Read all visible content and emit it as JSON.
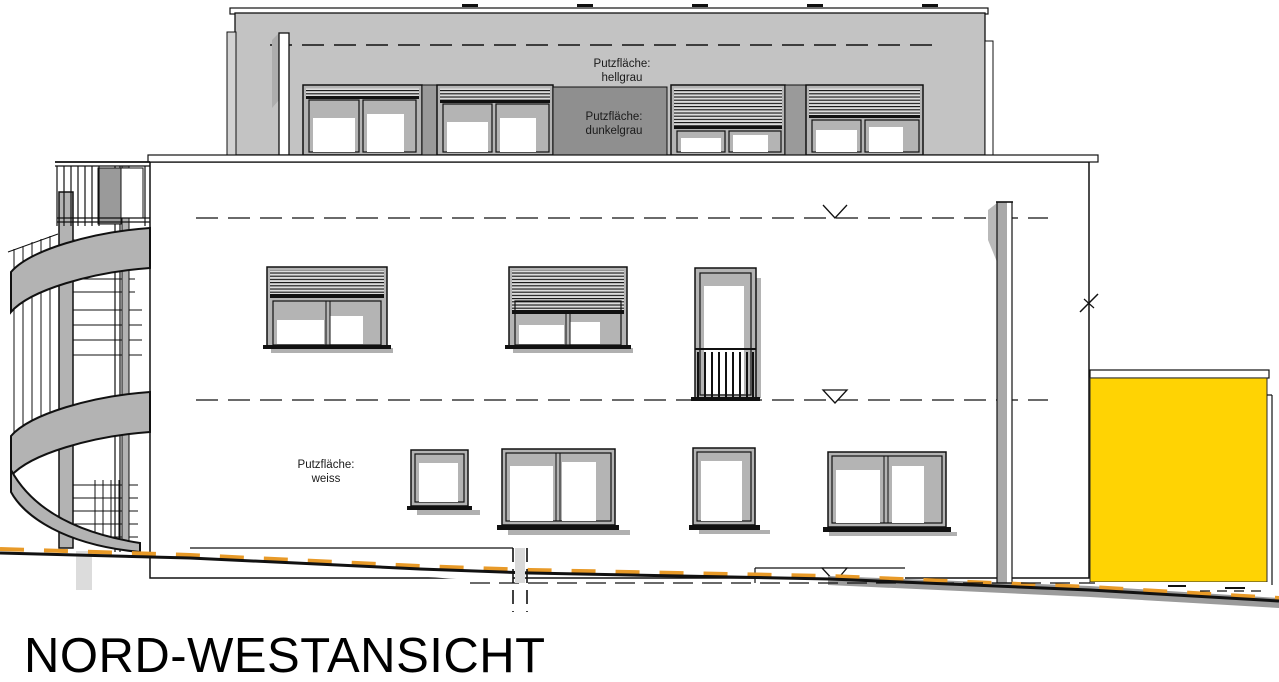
{
  "drawing": {
    "title": "NORD-WESTANSICHT",
    "annotations": {
      "hellgrau_line1": "Putzfläche:",
      "hellgrau_line2": "hellgrau",
      "dunkelgrau_line1": "Putzfläche:",
      "dunkelgrau_line2": "dunkelgrau",
      "weiss_line1": "Putzfläche:",
      "weiss_line2": "weiss"
    },
    "colors": {
      "plaster_hellgrau": "#c3c3c3",
      "plaster_dunkelgrau": "#8f8f8f",
      "plaster_weiss": "#ffffff",
      "accent_yellow": "#ffd303",
      "terrain_marker_orange": "#e89a28"
    }
  }
}
